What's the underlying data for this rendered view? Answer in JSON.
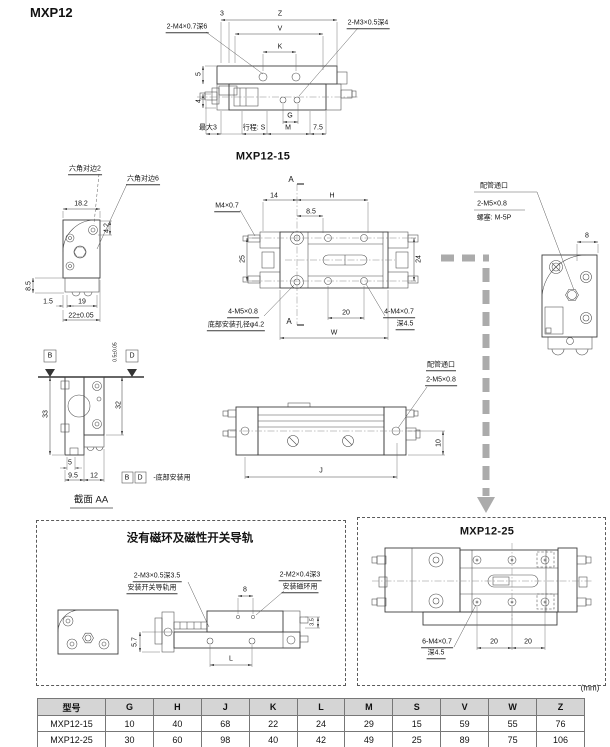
{
  "page": {
    "title": "MXP12",
    "unit_note": "(mm)"
  },
  "top_view": {
    "caption": "MXP12-15",
    "dims": {
      "d3": "3",
      "z": "Z",
      "v": "V",
      "k": "K",
      "d5": "5",
      "d4": "4",
      "thread_left": "2-M4×0.7深6",
      "thread_right": "2-M3×0.5深4",
      "max3": "最大3",
      "stroke": "行程: S",
      "m": "M",
      "g": "G",
      "d75": "7.5"
    }
  },
  "left_view": {
    "hex2": "六角对边2",
    "hex6": "六角对边6",
    "d182": "18.2",
    "d42": "4.2",
    "d85": "8.5",
    "d15": "1.5",
    "d19": "19",
    "d22": "22±0.05"
  },
  "main_view": {
    "a_top": "A",
    "a_bottom": "A",
    "d14": "14",
    "h": "H",
    "m4": "M4×0.7",
    "d85": "8.5",
    "d25": "25",
    "d24": "24",
    "thread_bottom": "4-M5×0.8",
    "hole_note": "底部安装孔径φ4.2",
    "d20": "20",
    "thread_right": "4-M4×0.7",
    "depth45": "深4.5",
    "w": "W"
  },
  "port_view": {
    "port": "配管通口",
    "thread": "2-M5×0.8",
    "plug": "螺塞: M-5P",
    "d8": "8"
  },
  "section_view": {
    "b": "B",
    "d": "D",
    "tol": "0.5±0.05",
    "d33": "33",
    "d32": "32",
    "d5": "5",
    "d95": "9.5",
    "d12": "12",
    "note_b": "B",
    "note_d": "D",
    "note_text": "-底部安装用",
    "caption": "截面 AA"
  },
  "side_view": {
    "port": "配管通口",
    "thread": "2-M5×0.8",
    "d10": "10",
    "j": "J"
  },
  "no_magnet_box": {
    "title": "没有磁环及磁性开关导轨",
    "rail_thread": "2-M3×0.5深3.5",
    "rail_note": "安装开关导轨用",
    "magnet_thread": "2-M2×0.4深3",
    "magnet_note": "安装磁环用",
    "d8": "8",
    "d57": "5.7",
    "l": "L",
    "d35": "3.5"
  },
  "mxp25_box": {
    "title": "MXP12-25",
    "thread": "6-M4×0.7",
    "depth": "深4.5",
    "d20a": "20",
    "d20b": "20"
  },
  "table": {
    "headers": [
      "型号",
      "G",
      "H",
      "J",
      "K",
      "L",
      "M",
      "S",
      "V",
      "W",
      "Z"
    ],
    "rows": [
      [
        "MXP12-15",
        "10",
        "40",
        "68",
        "22",
        "24",
        "29",
        "15",
        "59",
        "55",
        "76"
      ],
      [
        "MXP12-25",
        "30",
        "60",
        "98",
        "40",
        "42",
        "49",
        "25",
        "89",
        "75",
        "106"
      ]
    ]
  }
}
